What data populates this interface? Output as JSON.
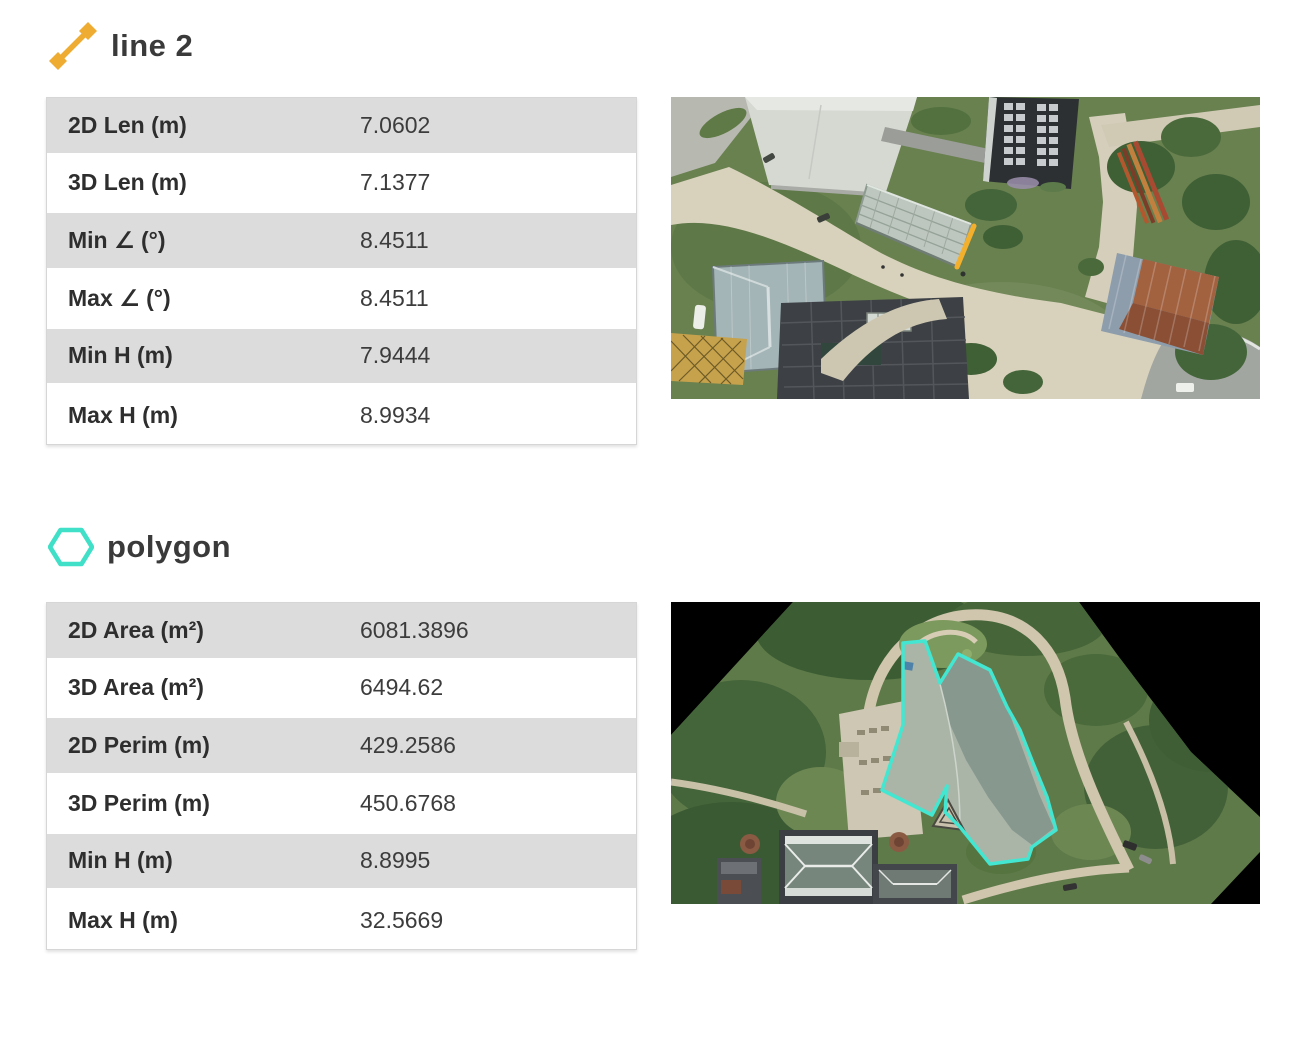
{
  "page": {
    "background": "#ffffff"
  },
  "colors": {
    "line_accent": "#EFAC33",
    "polygon_accent": "#3FE0C7",
    "polygon_overlay": "#43E6D0",
    "marker_yellow": "#F2B02C",
    "row_gray": "#DCDCDC",
    "text_dark": "#3A3A3A"
  },
  "sections": [
    {
      "title": "line 2",
      "icon": "line-icon",
      "rows": [
        {
          "label": "2D Len (m)",
          "value": "7.0602"
        },
        {
          "label": "3D Len (m)",
          "value": "7.1377"
        },
        {
          "label": "Min ∠ (°)",
          "value": "8.4511"
        },
        {
          "label": "Max ∠ (°)",
          "value": "8.4511"
        },
        {
          "label": "Min H (m)",
          "value": "7.9444"
        },
        {
          "label": "Max H (m)",
          "value": "8.9934"
        }
      ]
    },
    {
      "title": "polygon",
      "icon": "hexagon-icon",
      "rows": [
        {
          "label": "2D Area (m²)",
          "value": "6081.3896"
        },
        {
          "label": "3D Area (m²)",
          "value": "6494.62"
        },
        {
          "label": "2D Perim (m)",
          "value": "429.2586"
        },
        {
          "label": "3D Perim (m)",
          "value": "450.6768"
        },
        {
          "label": "Min H (m)",
          "value": "8.8995"
        },
        {
          "label": "Max H (m)",
          "value": "32.5669"
        }
      ]
    }
  ]
}
